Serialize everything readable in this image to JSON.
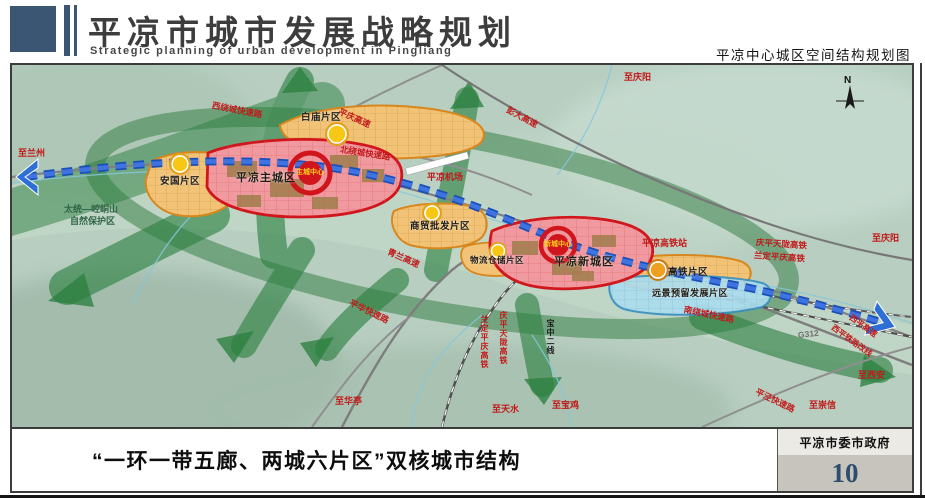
{
  "header": {
    "title_cn": "平凉市城市发展战略规划",
    "title_en": "Strategic planning of urban development in Pingliang",
    "subtitle_right": "平凉中心城区空间结构规划图"
  },
  "map": {
    "compass": "N",
    "labels": {
      "to_lanzhou": "至兰州",
      "to_qingyang_top": "至庆阳",
      "to_qingyang_right": "至庆阳",
      "to_xian": "至西安",
      "to_chongxin": "至崇信",
      "to_baoji": "至宝鸡",
      "to_tianshui": "至天水",
      "to_huating": "至华亭",
      "exp_pingqing": "平庆高速",
      "exp_pengda": "彭大高速",
      "rd_west_ring": "西绕城快速路",
      "rd_north_ring": "北绕城快速路",
      "exp_qinglan": "青兰高速",
      "rd_pinghua": "平华快速路",
      "rd_south_ring": "南绕城快速路",
      "rd_g312": "G312",
      "rd_pingjing": "平泾快速路",
      "exp_xiping": "西平高速",
      "rail_xiping_realign": "西平铁路改线",
      "rail_qingpingtianlong_h": "庆平天陇高铁",
      "rail_landingpingqing_h": "兰定平庆高铁",
      "rail_landingpingqing_v": "兰定平庆高铁",
      "rail_qingpingtianlong_v": "庆平天陇高铁",
      "rail_baozhong": "宝中二线",
      "airport": "平凉机场",
      "hsr_station": "平凉高铁站",
      "nature_reserve_1": "太统—崆峒山",
      "nature_reserve_2": "自然保护区",
      "zone_anguo": "安国片区",
      "zone_baimiao": "白庙片区",
      "zone_main_city": "平凉主城区",
      "zone_trade": "商贸批发片区",
      "zone_logistics": "物流仓储片区",
      "zone_new_city": "平凉新城区",
      "zone_hsr": "高铁片区",
      "zone_reserved": "远景预留发展片区",
      "core_main": "主城中心",
      "core_new": "新城中心"
    },
    "colors": {
      "terrain": "#b7cec0",
      "corridor_green": "#2c8040",
      "zone_red": "#d0161c",
      "zone_orange": "#d8871e",
      "zone_blue": "#3a8fc0",
      "belt_blue": "#2458c8",
      "node_yellow": "#f8c715"
    }
  },
  "footer": {
    "caption": "“一环一带五廊、两城六片区”双核城市结构",
    "credit": "平凉市委市政府",
    "page_number": "10"
  }
}
